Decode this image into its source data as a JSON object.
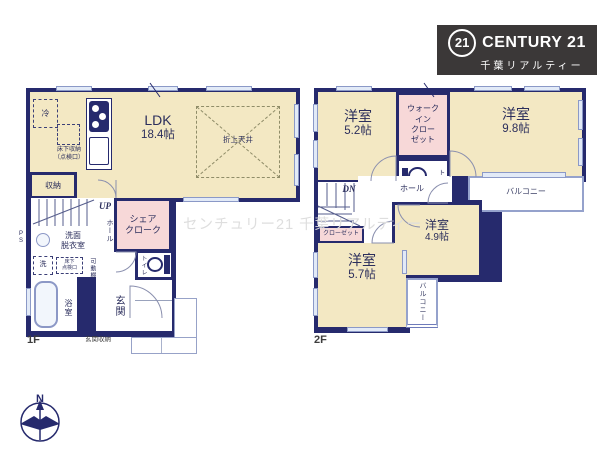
{
  "logo": {
    "badge": "21",
    "brand": "CENTURY 21",
    "sub": "千葉リアルティー"
  },
  "watermark": "センチュリー21 千葉リアルティー",
  "compass_n": "N",
  "floor1": {
    "label": "1F",
    "ldk_name": "LDK",
    "ldk_size": "18.4帖",
    "coffered_ceiling": "折上天井",
    "fridge": "冷",
    "underfloor_storage": "床下収納\n（点検口）",
    "storage": "収納",
    "up": "UP",
    "ps": "P\nS",
    "hall": "ホール",
    "share_cloak": "シェア\nクローク",
    "washroom": "洗面\n脱衣室",
    "washer": "洗",
    "underfloor_hatch": "床下\n点検口",
    "movable_shelf": "可動棚",
    "bathroom": "浴室",
    "toilet": "トイレ",
    "entrance": "玄関",
    "entrance_storage": "玄関収納"
  },
  "floor2": {
    "label": "2F",
    "room_a_name": "洋室",
    "room_a_size": "5.2帖",
    "wic": "ウォーク\nイン\nクロー\nゼット",
    "toilet": "トイレ",
    "room_b_name": "洋室",
    "room_b_size": "9.8帖",
    "balcony_top": "バルコニー",
    "closet_side": "クローゼット",
    "dn": "DN",
    "hall": "ホール",
    "room_c_name": "洋室",
    "room_c_size": "4.9帖",
    "closet_strip": "クローゼット",
    "room_d_name": "洋室",
    "room_d_size": "5.7帖",
    "balcony_side": "バルコニー"
  }
}
